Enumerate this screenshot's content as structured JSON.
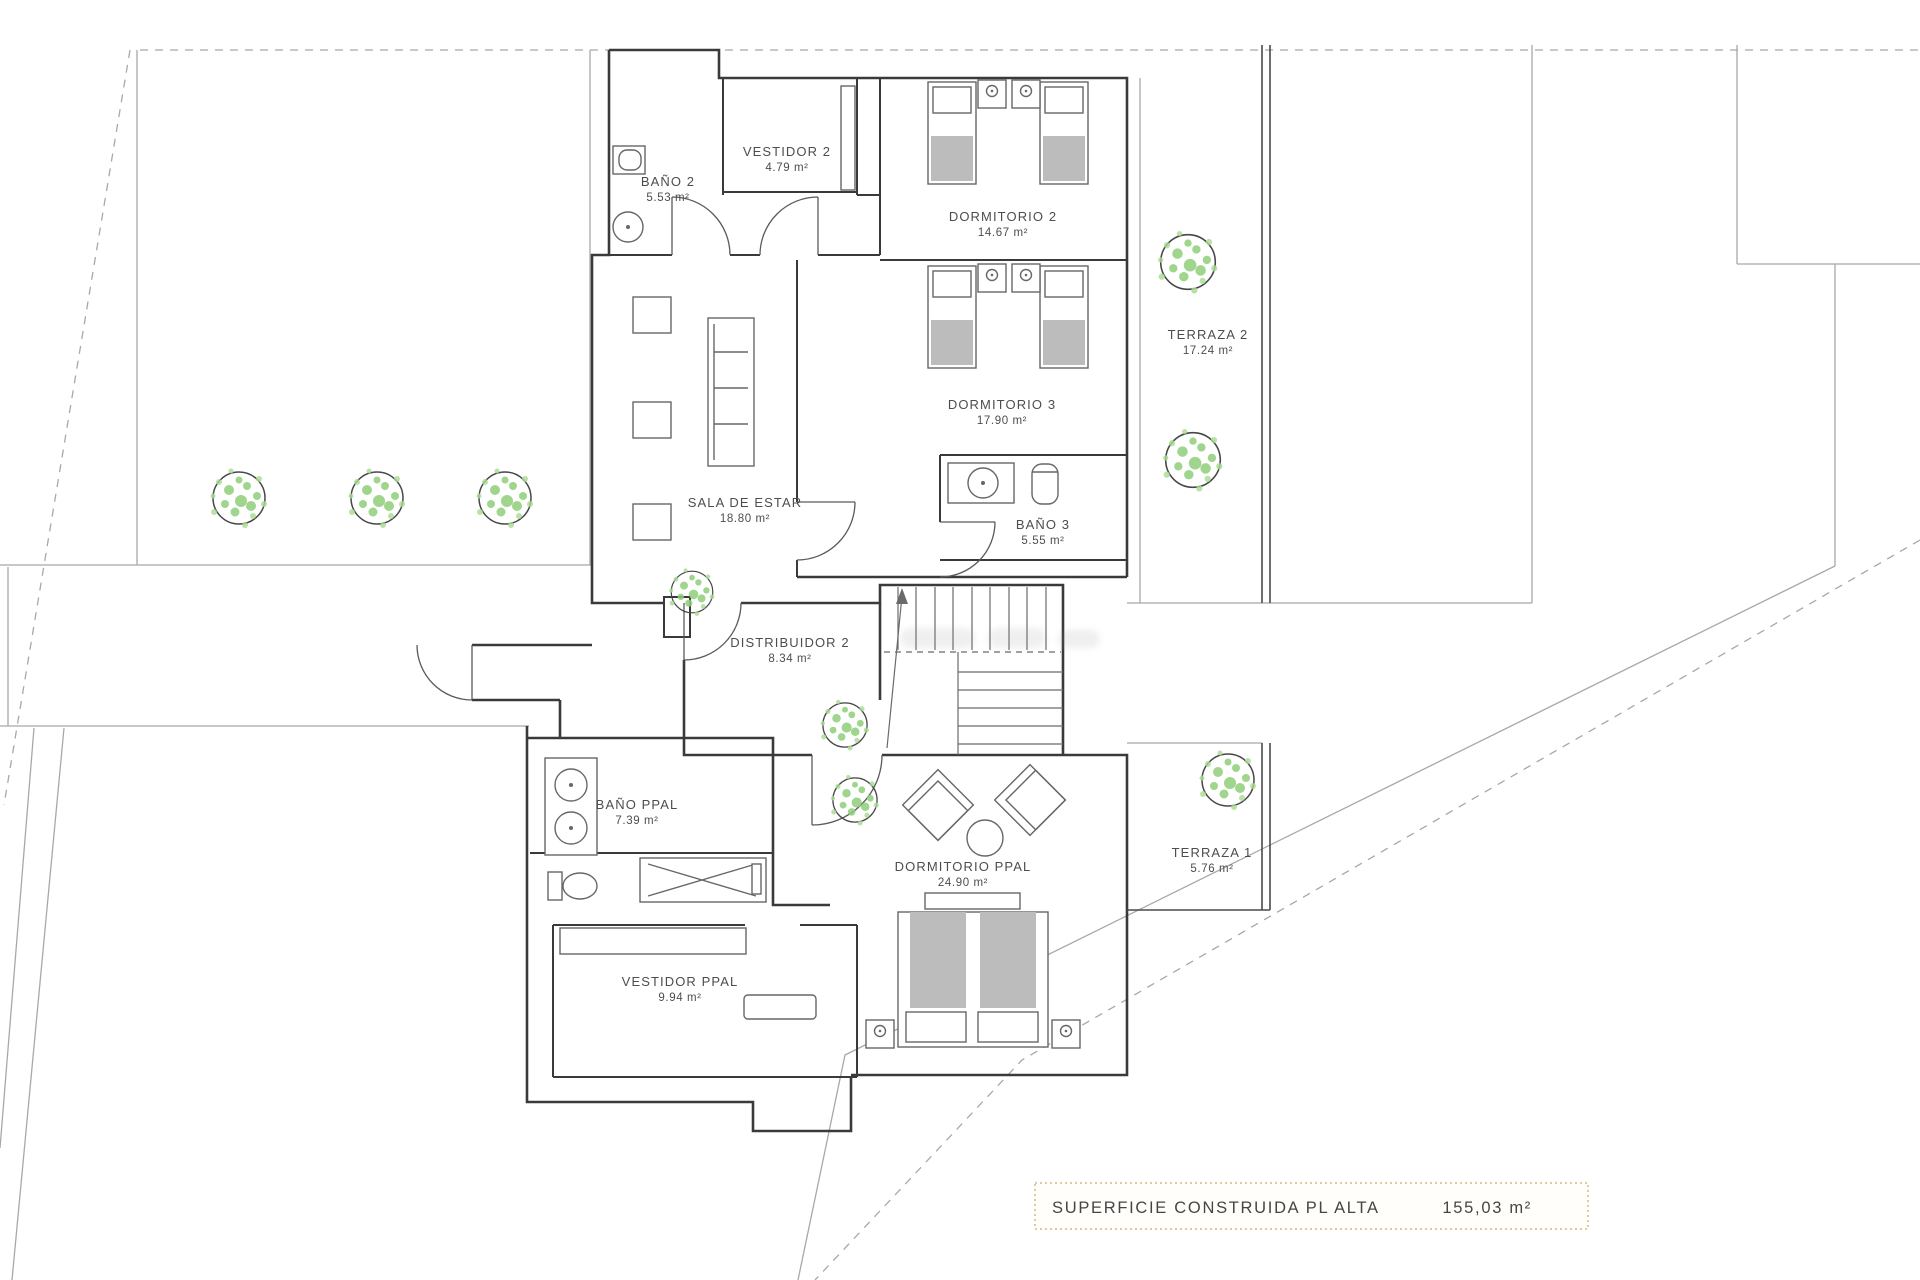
{
  "plan": {
    "title": "Floor plan - planta alta",
    "rooms": [
      {
        "label": "BAÑO 2",
        "area": "5.53 m²"
      },
      {
        "label": "VESTIDOR 2",
        "area": "4.79 m²"
      },
      {
        "label": "DORMITORIO 2",
        "area": "14.67 m²"
      },
      {
        "label": "DORMITORIO 3",
        "area": "17.90 m²"
      },
      {
        "label": "TERRAZA 2",
        "area": "17.24 m²"
      },
      {
        "label": "BAÑO 3",
        "area": "5.55 m²"
      },
      {
        "label": "SALA DE ESTAR",
        "area": "18.80 m²"
      },
      {
        "label": "DISTRIBUIDOR 2",
        "area": "8.34 m²"
      },
      {
        "label": "BAÑO PPAL",
        "area": "7.39 m²"
      },
      {
        "label": "DORMITORIO PPAL",
        "area": "24.90 m²"
      },
      {
        "label": "TERRAZA 1",
        "area": "5.76 m²"
      },
      {
        "label": "VESTIDOR  PPAL",
        "area": "9.94 m²"
      }
    ],
    "summary": {
      "label": "SUPERFICIE CONSTRUIDA PL ALTA",
      "value": "155,03 m²"
    },
    "colors": {
      "wall": "#3a3a3a",
      "site_line": "#a8a8a8",
      "tree_green": "#8fce78",
      "summary_border": "#e3c99e"
    }
  }
}
